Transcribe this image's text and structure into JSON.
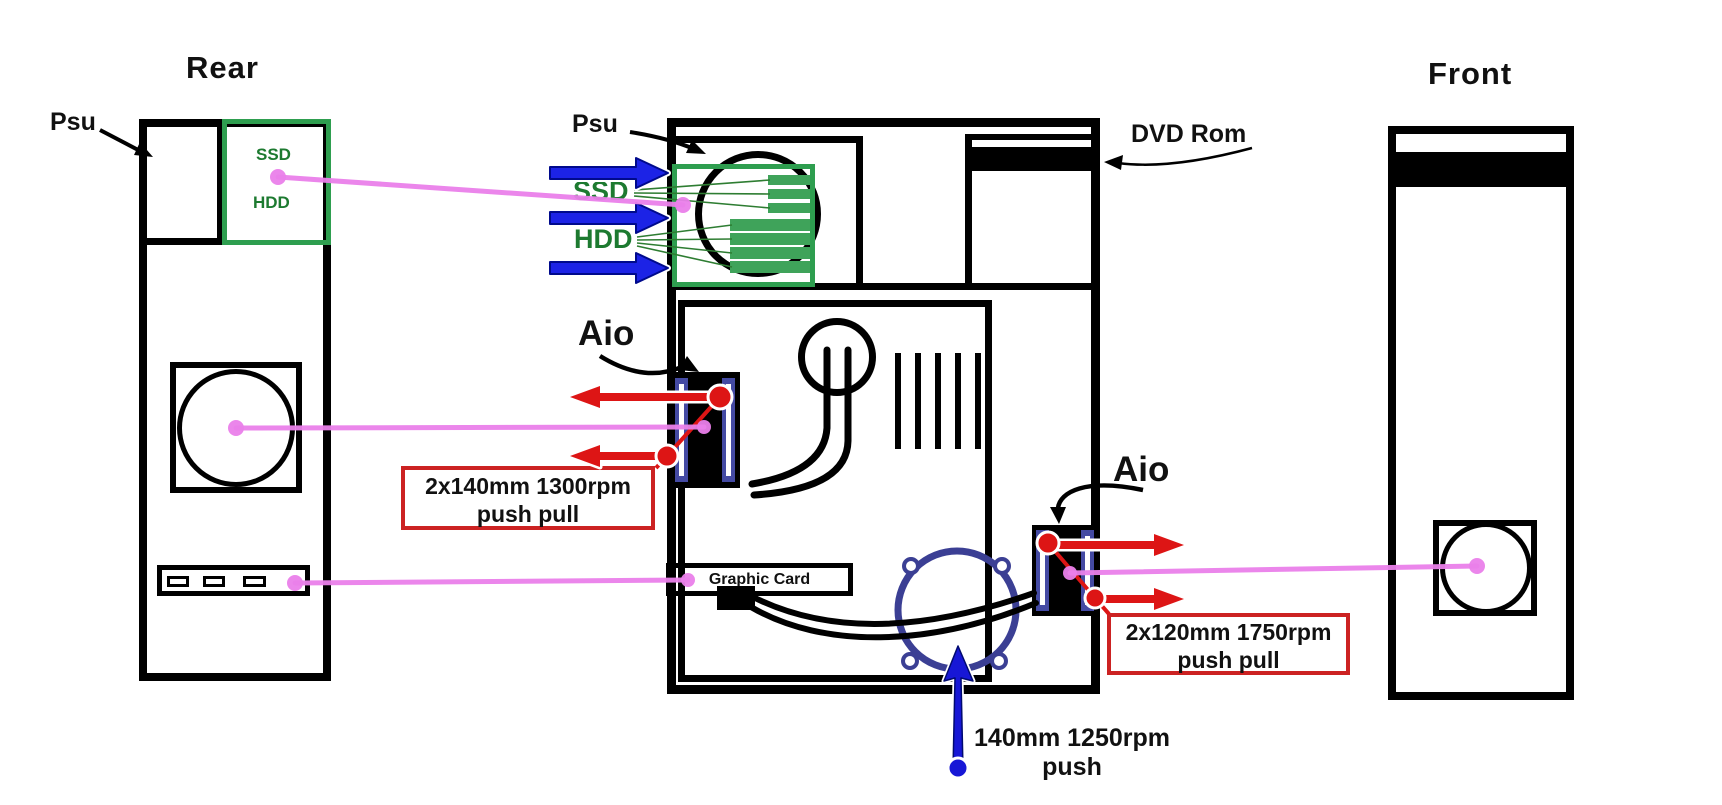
{
  "rear_view": {
    "title": "Rear",
    "psu_label": "Psu",
    "ssd_label": "SSD",
    "hdd_label": "HDD"
  },
  "side_view": {
    "psu_label": "Psu",
    "ssd_label": "SSD",
    "hdd_label": "HDD",
    "dvd_label": "DVD Rom",
    "aio_rear_label": "Aio",
    "aio_front_label": "Aio",
    "graphic_card_label": "Graphic Card"
  },
  "front_view": {
    "title": "Front"
  },
  "fan_specs": {
    "aio_rear": {
      "line1": "2x140mm 1300rpm",
      "line2": "push pull"
    },
    "aio_front": {
      "line1": "2x120mm 1750rpm",
      "line2": "push pull"
    },
    "bottom_fan": {
      "line1": "140mm 1250rpm",
      "line2": "push"
    }
  },
  "colors": {
    "drive_box_green": "#2e9e4f",
    "drive_stripe_green": "#3fa35a",
    "drive_label_green": "#1d7a30",
    "connector_pink": "#ea80ea",
    "airflow_blue": "#1c23e6",
    "airflow_red": "#dd1515",
    "aio_fan_blue": "#444aa3",
    "bottom_fan_blue": "#3b3f94",
    "spec_box_red": "#cc2222"
  }
}
